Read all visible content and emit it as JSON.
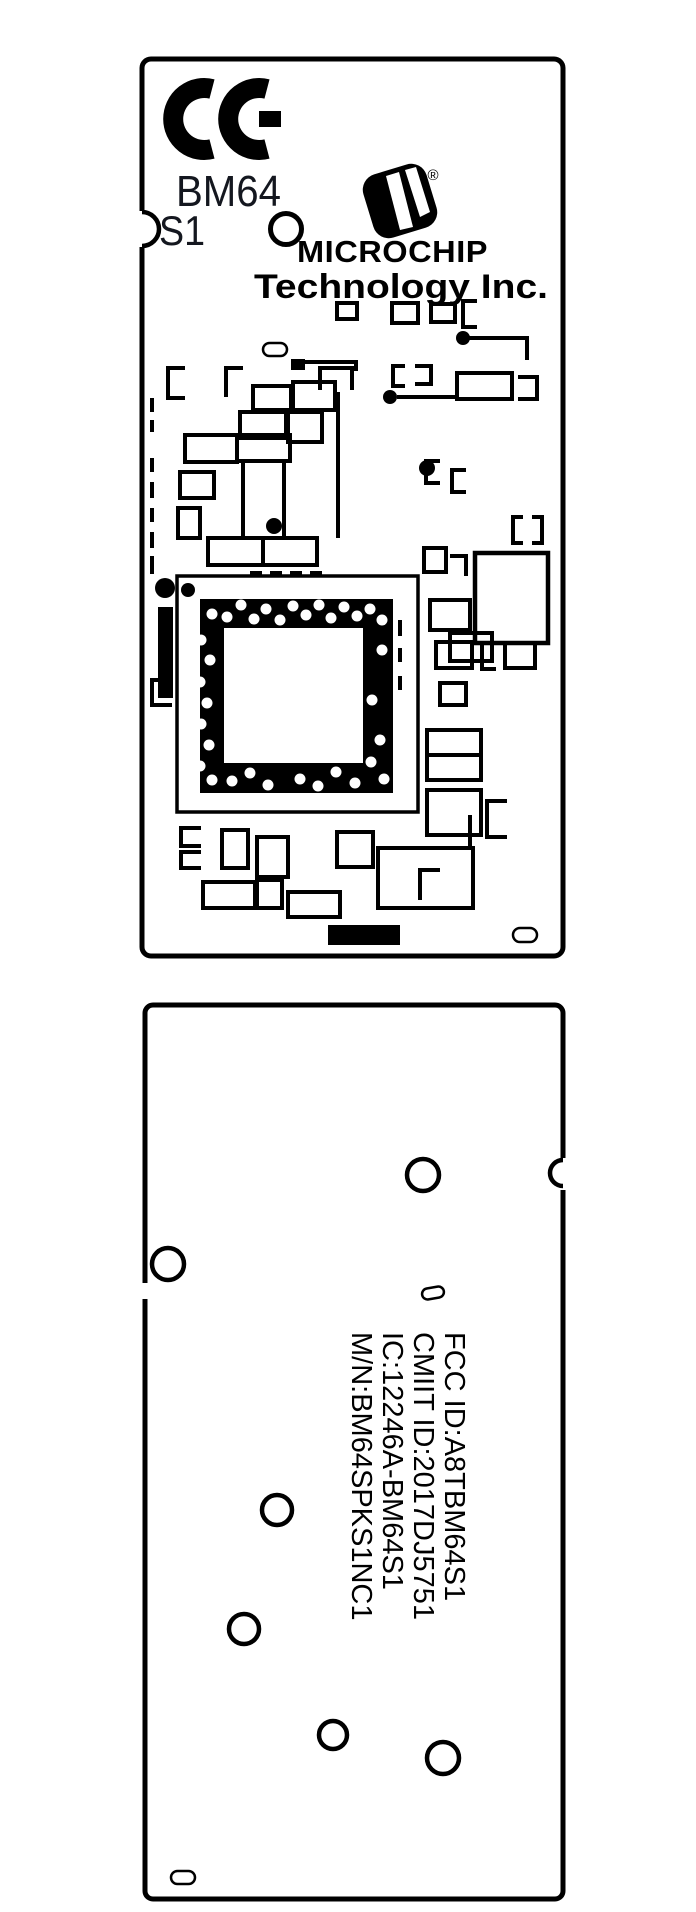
{
  "page": {
    "title": "BM64 module top and bottom view drawing",
    "background": "#ffffff",
    "ink": "#000000",
    "model_text_color": "#14171f"
  },
  "top_view": {
    "ce_mark": "CE",
    "model": {
      "line1": "BM64",
      "line2": "S1"
    },
    "registered": "®",
    "brand": "MICROCHIP",
    "brand_suffix": "Technology Inc.",
    "icons": {
      "ce": "ce-mark",
      "logo": "microchip-logo",
      "hole": "fiducial-hole",
      "chip": "qfn-chip-footprint",
      "test_point": "test-point-oval"
    }
  },
  "bottom_view": {
    "labels": [
      "FCC ID:A8TBM64S1",
      "CMIIT ID:2017DJ5751",
      "IC:12246A-BM64S1",
      "M/N:BM64SPKS1NC1"
    ],
    "icons": {
      "hole": "mounting-hole",
      "test_point": "test-point-oval"
    }
  }
}
